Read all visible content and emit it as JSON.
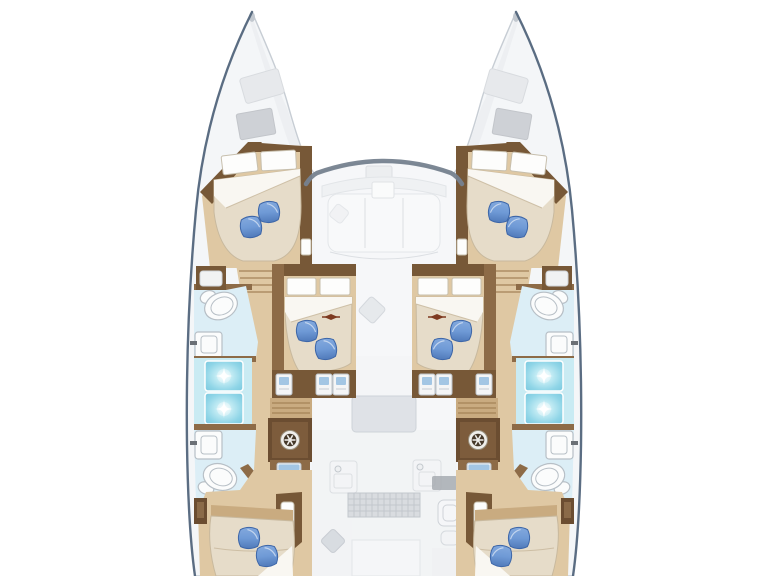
{
  "meta": {
    "title": "Catamaran yacht deck layout plan — top view",
    "view": "top-down floor plan, bows up, stern cut off at bottom edge"
  },
  "colors": {
    "hullFill": "#f4f6f8",
    "hullStroke": "#c7cdd4",
    "accentNavy": "#50647b",
    "windshield": "#76828f",
    "deckHatchLight": "#e7e9ec",
    "deckHatchDark": "#ced1d6",
    "woodDark": "#775837",
    "woodMid": "#8d6b47",
    "woodCabinet": "#6b4d31",
    "floorTan": "#dfc8a3",
    "floorTanDark": "#c9ab80",
    "stepLine": "#a58257",
    "mattress": "#e6dcc9",
    "mattressEdge": "#c8b99e",
    "sheetWhite": "#f9f7f2",
    "pillowLight": "#8fb2e2",
    "pillowMid": "#6f9ad6",
    "pillowDark": "#3d66a8",
    "showerCyan": "#8fd5e7",
    "showerCyanLight": "#c9ebf3",
    "bathFloor": "#dceef6",
    "fixtureWhite": "#fbfcfc",
    "fixtureStroke": "#b7bfc6",
    "ghostFill": "#f3f4f6",
    "ghostStroke": "#dcdfe3",
    "arrowRed": "#7e3a20",
    "applianceBlue": "#a3c6e4"
  },
  "inventory": {
    "hulls": 2,
    "forward_cabins": 2,
    "midship_cabins": 2,
    "aft_cabins": 2,
    "double_beds": 6,
    "blue_pillows": 12,
    "toilets": 4,
    "washbasins": 4,
    "shower_stalls": 4,
    "helm_wheel_icons": 2,
    "deck_hatches": 4,
    "drawer_units": 6,
    "appliance_panels": 4,
    "center_areas": [
      "forward cockpit seating",
      "saloon with table",
      "galley with sink, stove and grate",
      "aft cockpit (faded)"
    ]
  }
}
